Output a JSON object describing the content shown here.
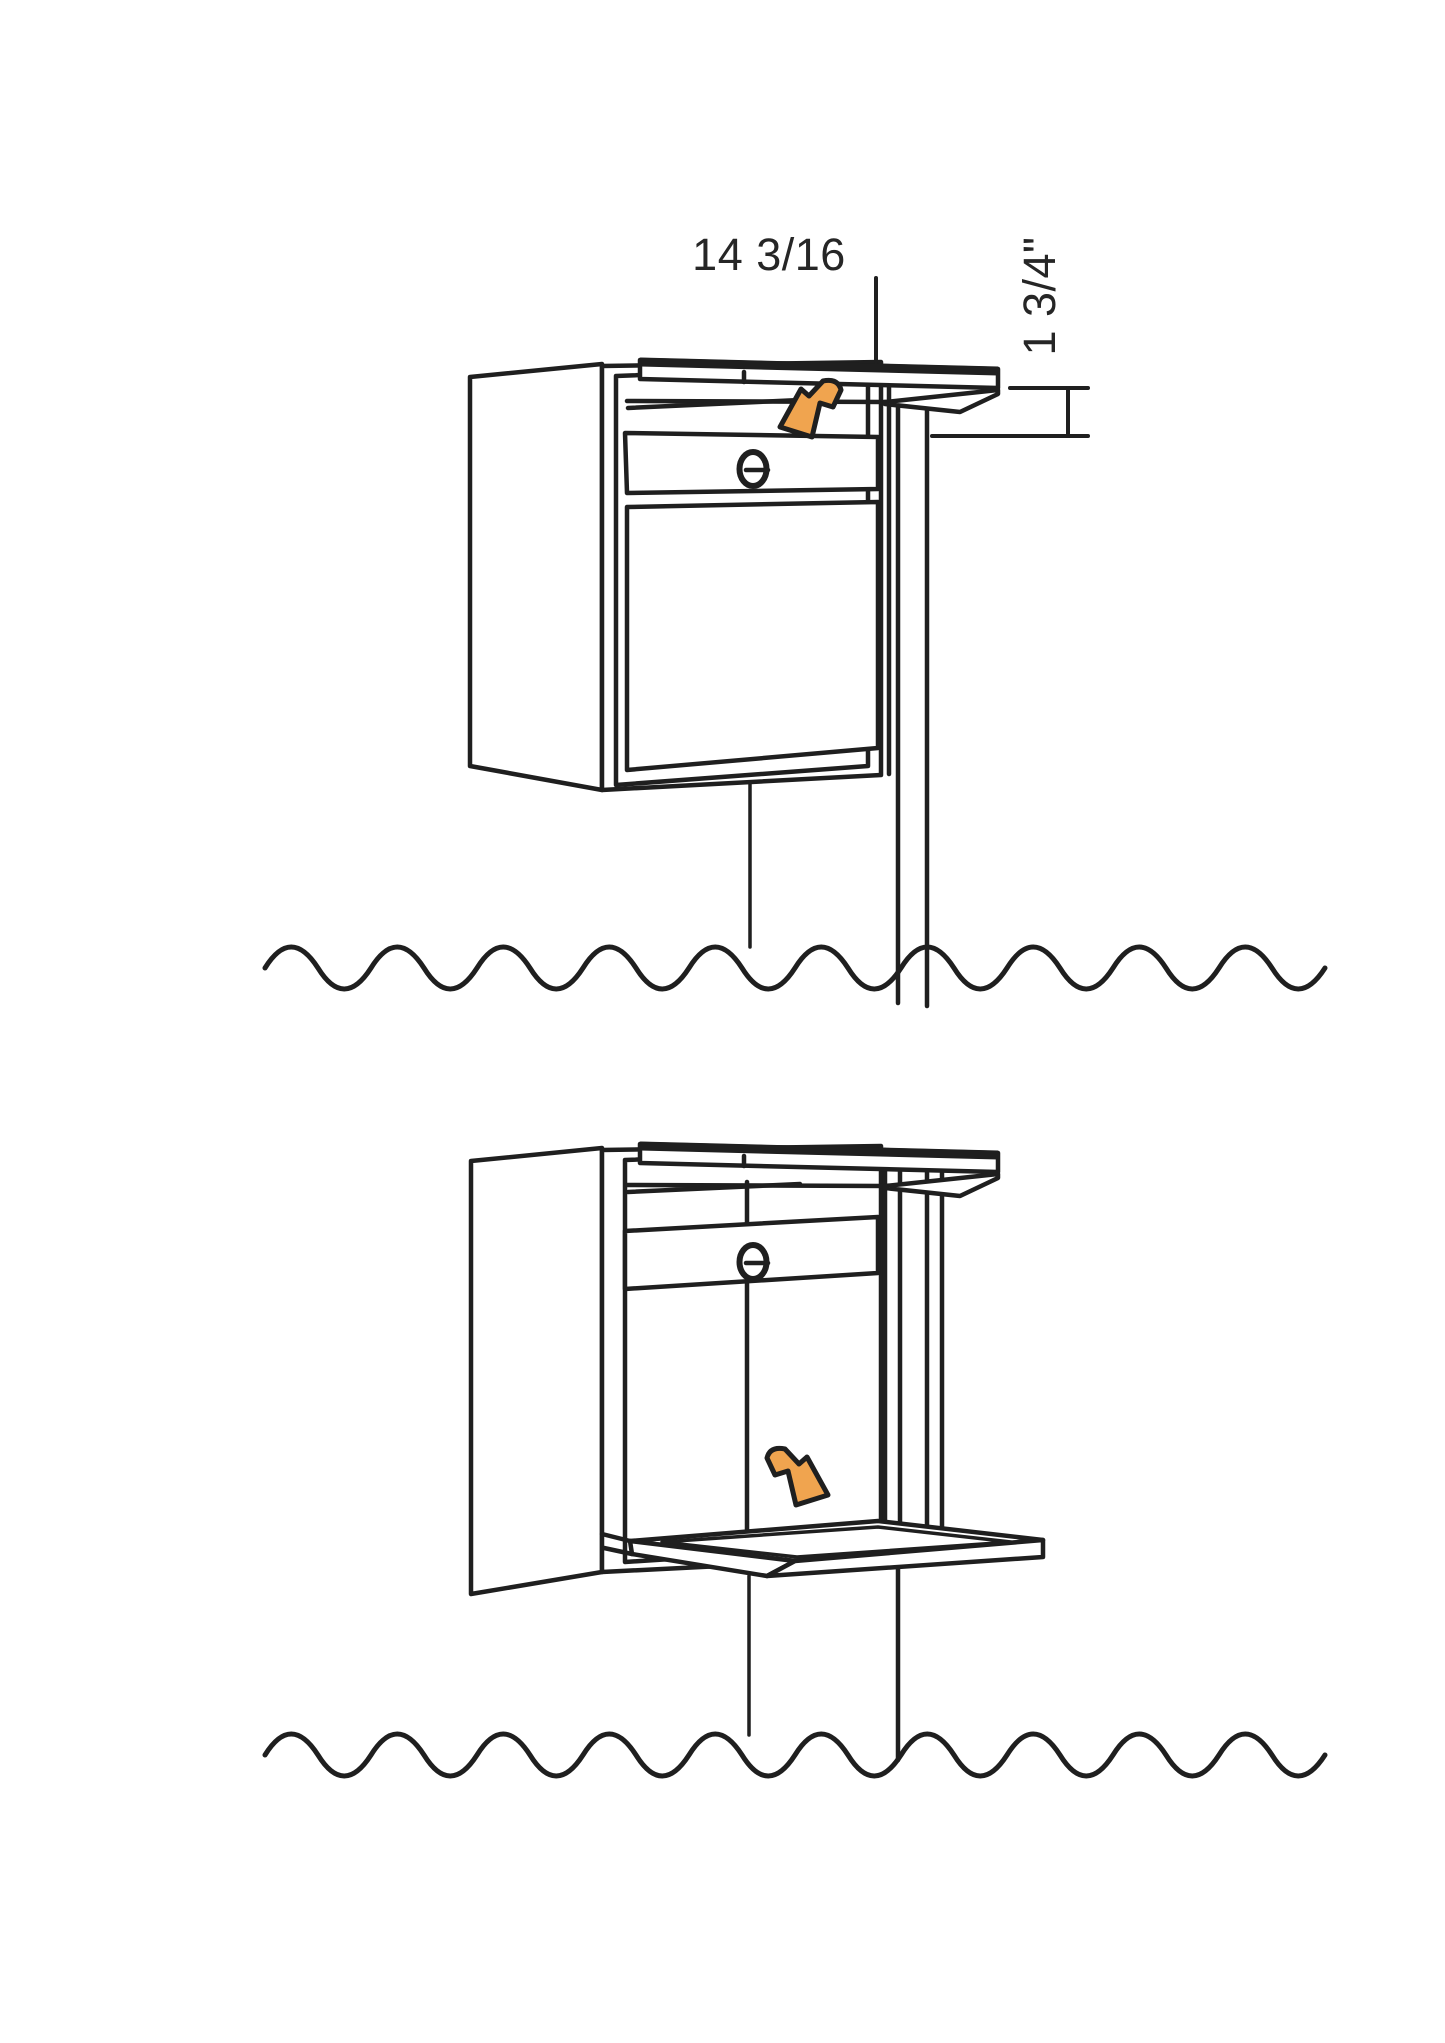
{
  "page": {
    "background": "#ffffff"
  },
  "drawing": {
    "ink": "#1f1f1f",
    "arrow_fill": "#F0A44F",
    "arrow_outline": "#1f1f1f"
  },
  "dimensions": {
    "width_label": "14 3/16",
    "gap_label": "1 3/4\""
  },
  "icons": {
    "slot_arrow": "bent-arrow-down-left",
    "door_arrow": "bent-arrow-down-right",
    "lock": "cam-lock-oval"
  }
}
